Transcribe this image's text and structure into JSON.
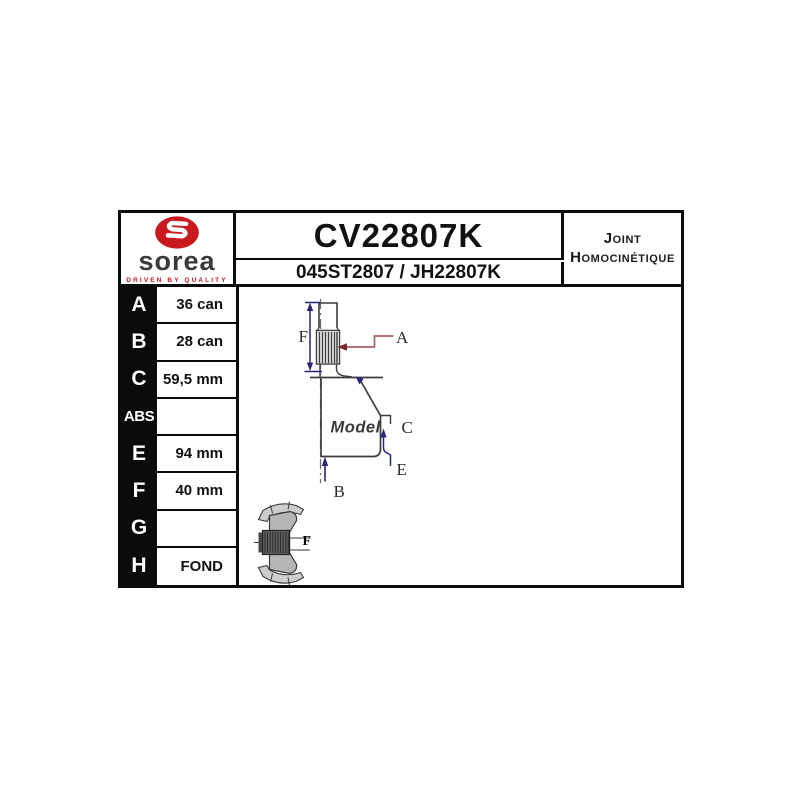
{
  "header": {
    "logo": {
      "brand": "sorea",
      "tagline": "DRIVEN BY QUALITY"
    },
    "part_number": "CV22807K",
    "reference": "045ST2807 / JH22807K",
    "product_type": {
      "line1": "Joint",
      "line2": "Homocinétique"
    }
  },
  "spec_table": {
    "rows": [
      {
        "key": "A",
        "value": "36 can"
      },
      {
        "key": "B",
        "value": "28 can"
      },
      {
        "key": "C",
        "value": "59,5 mm"
      },
      {
        "key": "ABS",
        "value": ""
      },
      {
        "key": "E",
        "value": "94 mm"
      },
      {
        "key": "F",
        "value": "40 mm"
      },
      {
        "key": "G",
        "value": ""
      },
      {
        "key": "H",
        "value": "FOND"
      }
    ]
  },
  "diagram": {
    "model_label": "Model",
    "labels": {
      "a": "A",
      "b": "B",
      "c": "C",
      "e": "E",
      "f": "F",
      "icon_f": "F"
    },
    "colors": {
      "dimension_blue": "#26267d",
      "leader_red": "#7c2222",
      "outline_gray": "#3d3d3d",
      "logo_red": "#c8191f",
      "border_black": "#0b0b0b"
    }
  }
}
